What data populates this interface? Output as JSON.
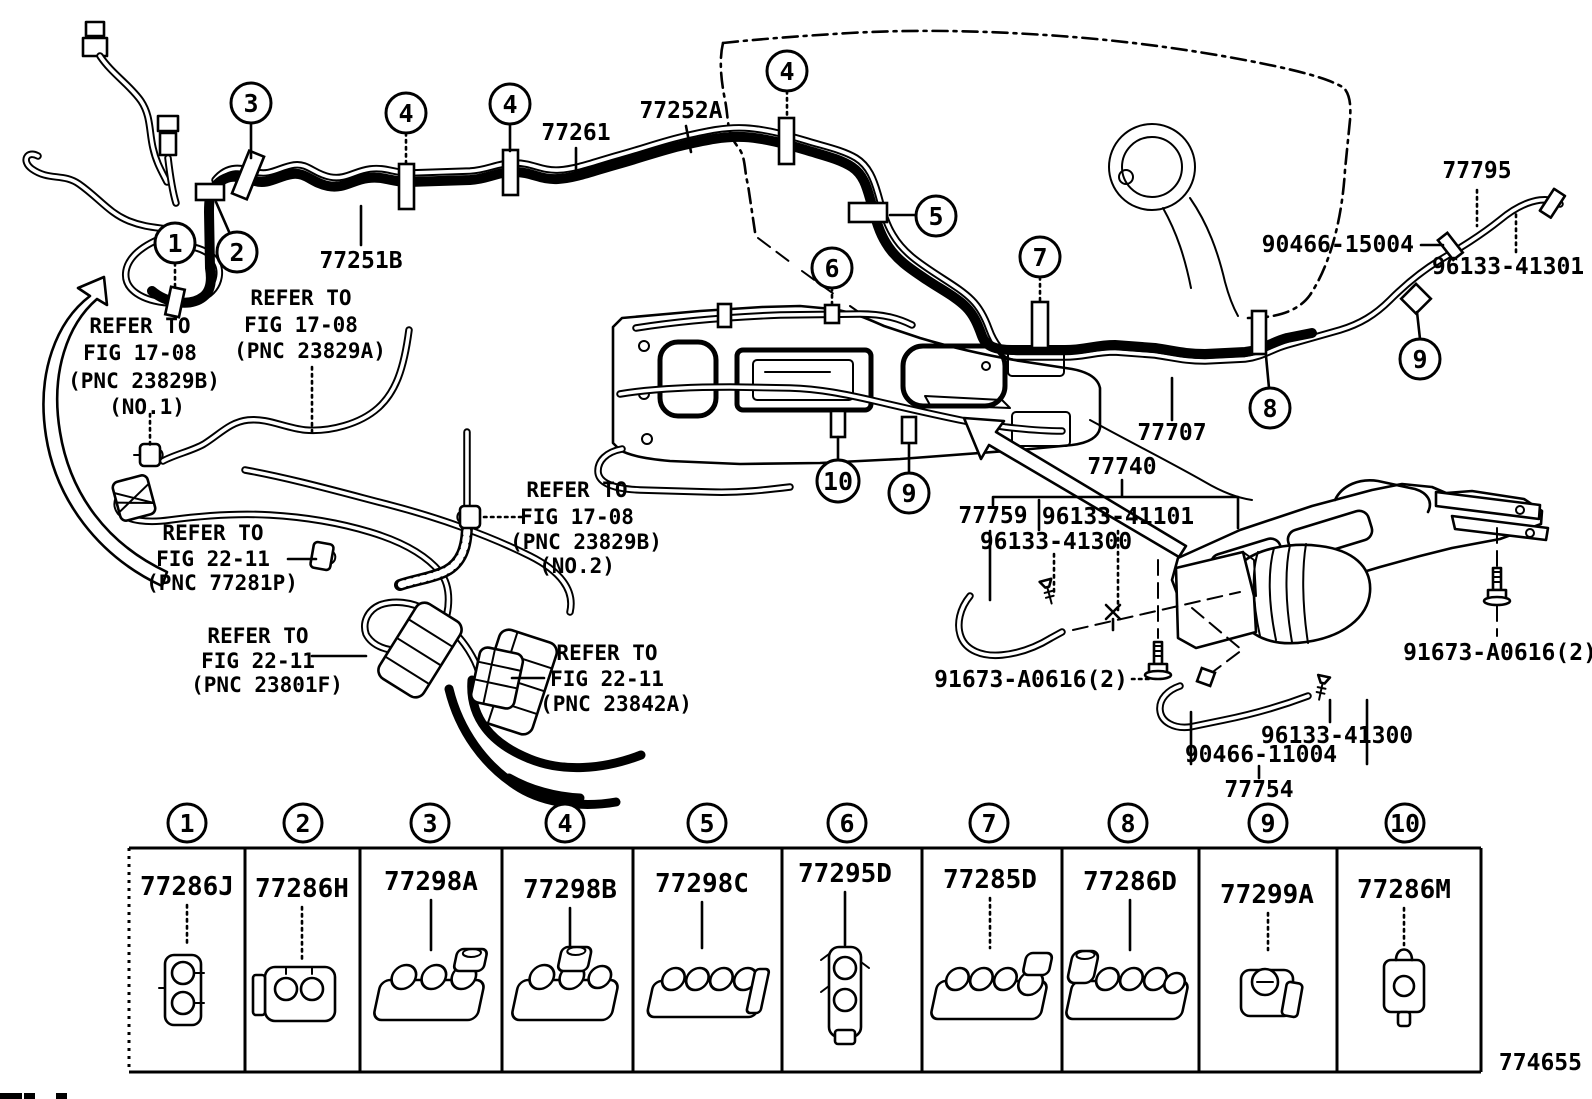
{
  "figure_number": "774655",
  "diagram": {
    "part_labels": {
      "p77261": "77261",
      "p77252A": "77252A",
      "p77251B": "77251B",
      "p77795": "77795",
      "p90466_15004": "90466-15004",
      "p96133_41301": "96133-41301",
      "p77707": "77707",
      "p77740": "77740",
      "p77759": "77759",
      "p96133_41101": "96133-41101",
      "p96133_41300_upper": "96133-41300",
      "p91673_left": "91673-A0616(2)",
      "p91673_right": "91673-A0616(2)",
      "p96133_41300_lower": "96133-41300",
      "p90466_11004": "90466-11004",
      "p77754": "77754"
    },
    "refer_notes": {
      "n1": {
        "lines": [
          "REFER TO",
          "FIG 17-08",
          "(PNC 23829B)",
          "(NO.1)"
        ]
      },
      "n2": {
        "lines": [
          "REFER TO",
          "FIG 17-08",
          "(PNC 23829A)"
        ]
      },
      "n3": {
        "lines": [
          "REFER TO",
          "FIG 17-08",
          "(PNC 23829B)",
          "(NO.2)"
        ]
      },
      "n4": {
        "lines": [
          "REFER TO",
          "FIG 22-11",
          "(PNC 77281P)"
        ]
      },
      "n5": {
        "lines": [
          "REFER TO",
          "FIG 22-11",
          "(PNC 23801F)"
        ]
      },
      "n6": {
        "lines": [
          "REFER TO",
          "FIG 22-11",
          "(PNC 23842A)"
        ]
      }
    },
    "callouts": [
      "1",
      "2",
      "3",
      "4",
      "4",
      "4",
      "5",
      "6",
      "7",
      "8",
      "9",
      "9",
      "10"
    ]
  },
  "legend": {
    "items": [
      {
        "no": "1",
        "part": "77286J"
      },
      {
        "no": "2",
        "part": "77286H"
      },
      {
        "no": "3",
        "part": "77298A"
      },
      {
        "no": "4",
        "part": "77298B"
      },
      {
        "no": "5",
        "part": "77298C"
      },
      {
        "no": "6",
        "part": "77295D"
      },
      {
        "no": "7",
        "part": "77285D"
      },
      {
        "no": "8",
        "part": "77286D"
      },
      {
        "no": "9",
        "part": "77299A"
      },
      {
        "no": "10",
        "part": "77286M"
      }
    ]
  }
}
